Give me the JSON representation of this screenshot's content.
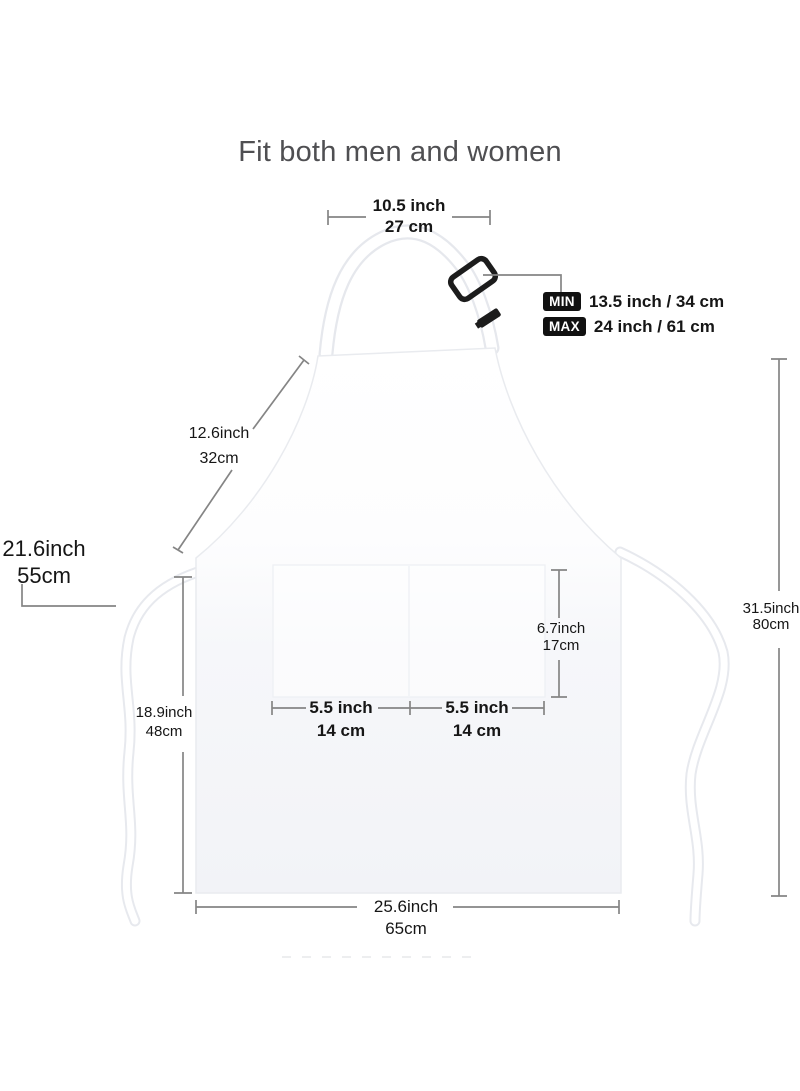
{
  "title": "Fit both men and women",
  "measurements": {
    "neck_strap_top_width": {
      "inch": "10.5 inch",
      "cm": "27 cm"
    },
    "neck_strap_adjust": {
      "min_label": "MIN",
      "min_value": "13.5 inch / 34 cm",
      "max_label": "MAX",
      "max_value": "24 inch / 61 cm"
    },
    "bib_side_length": {
      "inch": "12.6inch",
      "cm": "32cm"
    },
    "waist_tie_length": {
      "inch": "21.6inch",
      "cm": "55cm"
    },
    "skirt_height": {
      "inch": "18.9inch",
      "cm": "48cm"
    },
    "pocket_height": {
      "inch": "6.7inch",
      "cm": "17cm"
    },
    "pocket_left_width": {
      "inch": "5.5 inch",
      "cm": "14 cm"
    },
    "pocket_right_width": {
      "inch": "5.5 inch",
      "cm": "14 cm"
    },
    "total_height": {
      "inch": "31.5inch",
      "cm": "80cm"
    },
    "bottom_width": {
      "inch": "25.6inch",
      "cm": "65cm"
    }
  },
  "colors": {
    "badge_bg": "#111111",
    "badge_text": "#ffffff",
    "dim_line": "#858585",
    "text": "#161616",
    "title_text": "#4f4f52",
    "apron_outline": "#e9ebef"
  }
}
